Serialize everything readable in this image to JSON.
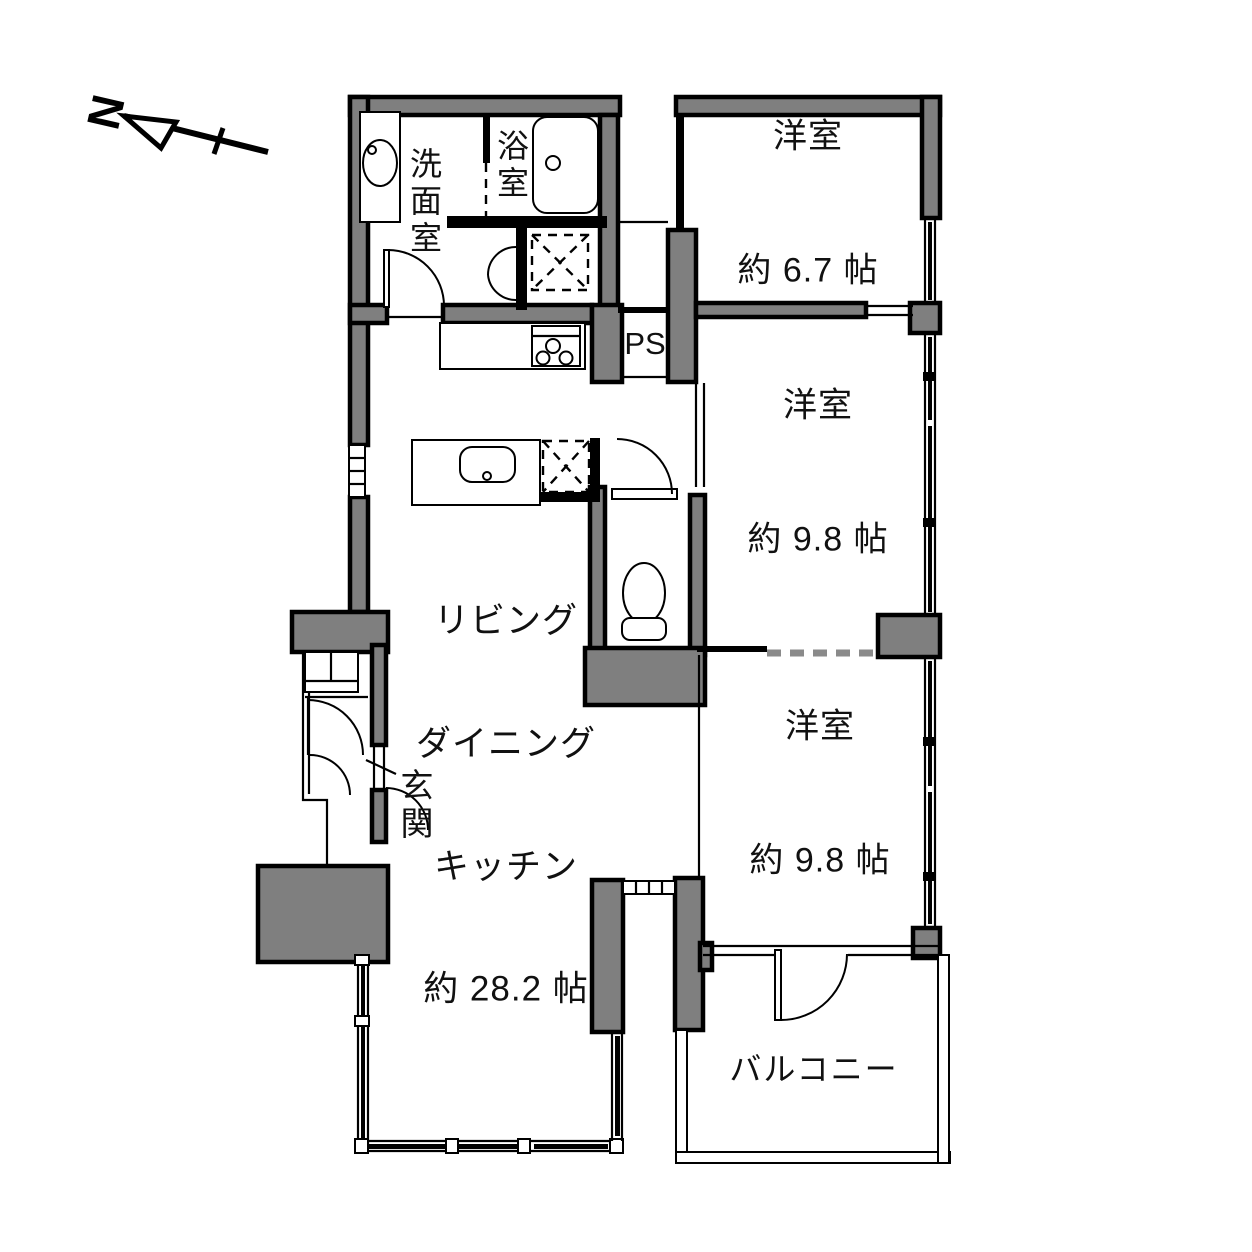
{
  "plan": {
    "labels": {
      "north": "N",
      "washroom": "洗面室",
      "bathroom": "浴室",
      "bedroom1_name": "洋室",
      "bedroom1_size": "約 6.7 帖",
      "ps": "PS",
      "bedroom2_name": "洋室",
      "bedroom2_size": "約 9.8 帖",
      "bedroom3_name": "洋室",
      "bedroom3_size": "約 9.8 帖",
      "ldk_line1": "リビング",
      "ldk_line2": "ダイニング",
      "ldk_line3": "キッチン",
      "ldk_size": "約 28.2 帖",
      "entrance": "玄関",
      "balcony": "バルコニー"
    },
    "colors": {
      "wall": "#7f7f7f",
      "outline": "#000000",
      "background": "#ffffff",
      "dashed_partition": "#8a8a8a"
    }
  }
}
